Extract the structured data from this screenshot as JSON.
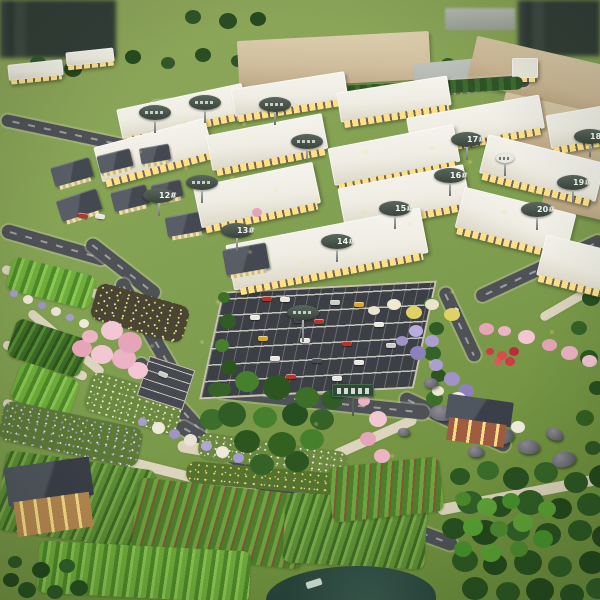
{
  "image": {
    "kind": "photograph of an architectural scale model",
    "alt": "Aerial photo of a miniature master-plan model: rows of white retail buildings with numbered oval signs, a central parking lot filled with toy cars, winding dark roads and cream footpaths, flower gardens in pink, purple, white and red, crop fields, village farmhouses, grey boulders and dense model forest."
  },
  "signs": {
    "buildings": [
      {
        "label": "12#"
      },
      {
        "label": "13#"
      },
      {
        "label": "14#"
      },
      {
        "label": "15#"
      },
      {
        "label": "16#"
      },
      {
        "label": "17#"
      },
      {
        "label": "18#"
      },
      {
        "label": "19#"
      },
      {
        "label": "20#"
      }
    ]
  },
  "palette": {
    "lawn": "#7d9c4e",
    "olive_lawn": "#7e9143",
    "road": "#4e5156",
    "asphalt": "#3c3f45",
    "footpath": "#dcd4bc",
    "roof_white": "#efede3",
    "window_glow": "#ffe089",
    "warehouse_tan": "#cdb896",
    "warehouse_grey": "#b6bab4",
    "village_roof": "#4d525c",
    "brick_wall": "#a05c40",
    "sign_dark": "#3e4a42",
    "sign_text": "#f2f5ef",
    "tree_dark": "#2d5a24",
    "tree_bright": "#66a438",
    "forest_deep": "#23481c",
    "blossom_pink": "#ecb3c4",
    "flower_purple": "#9f93c8",
    "flower_red": "#cf3a45",
    "rock_grey": "#6a6a72",
    "pond": "#2f4f45"
  }
}
